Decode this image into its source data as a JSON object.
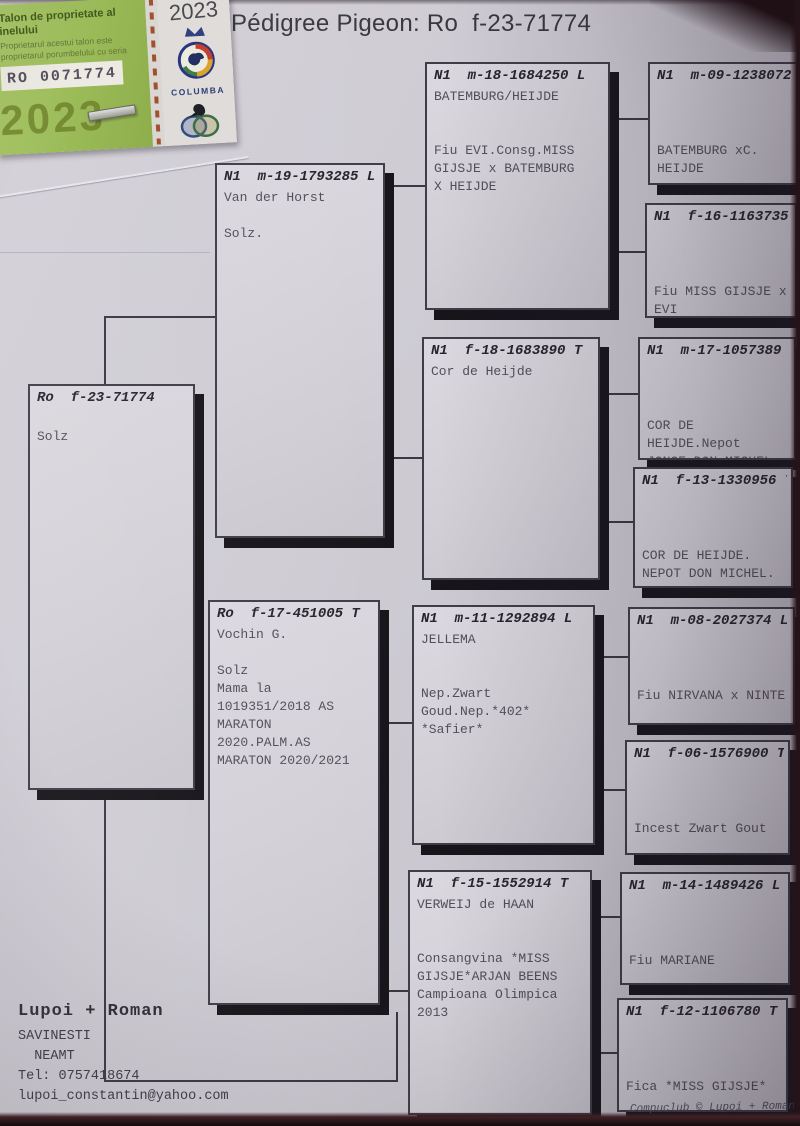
{
  "page": {
    "title": "Pédigree Pigeon: Ro  f-23-71774"
  },
  "sticker": {
    "title": "Talon de proprietate al inelului",
    "subtitle_line1": "Proprietarul acestui talon este",
    "subtitle_line2": "proprietarul porumbelului cu seria",
    "ring_number": "RO 0071774",
    "watermark_year": "2023",
    "right_year": "2023",
    "org_name": "COLUMBA"
  },
  "tree": {
    "boxes": [
      {
        "id": "subject",
        "ring": "Ro  f-23-71774",
        "body": "\nSolz"
      },
      {
        "id": "sire",
        "ring": "N1  m-19-1793285 L",
        "body": "Van der Horst\n\nSolz."
      },
      {
        "id": "dam",
        "ring": "Ro  f-17-451005 T",
        "body": "Vochin G.\n\nSolz\nMama la\n1019351/2018 AS\nMARATON\n2020.PALM.AS\nMARATON 2020/2021"
      },
      {
        "id": "sire-sire",
        "ring": "N1  m-18-1684250 L",
        "body": "BATEMBURG/HEIJDE\n\n\nFiu EVI.Consg.MISS\nGIJSJE x BATEMBURG\nX HEIJDE"
      },
      {
        "id": "sire-dam",
        "ring": "N1  f-18-1683890 T",
        "body": "Cor de Heijde"
      },
      {
        "id": "dam-sire",
        "ring": "N1  m-11-1292894 L",
        "body": "JELLEMA\n\n\nNep.Zwart\nGoud.Nep.*402*\n*Safier*"
      },
      {
        "id": "dam-dam",
        "ring": "N1  f-15-1552914 T",
        "body": "VERWEIJ de HAAN\n\n\nConsangvina *MISS\nGIJSJE*ARJAN BEENS\nCampioana Olimpica\n2013"
      },
      {
        "id": "sire-sire-sire",
        "ring": "N1  m-09-1238072 L",
        "body": "\n\n\nBATEMBURG xC.\nHEIJDE"
      },
      {
        "id": "sire-sire-dam",
        "ring": "N1  f-16-1163735 T",
        "body": "\n\n\nFiu MISS GIJSJE x\nEVI"
      },
      {
        "id": "sire-dam-sire",
        "ring": "N1  m-17-1057389 L",
        "body": "\n\n\nCOR DE HEIJDE.Nepot\nJONGE DON MICHEL"
      },
      {
        "id": "sire-dam-dam",
        "ring": "N1  f-13-1330956 T",
        "body": "\n\n\nCOR DE HEIJDE.\nNEPOT DON MICHEL."
      },
      {
        "id": "dam-sire-sire",
        "ring": "N1  m-08-2027374 L",
        "body": "\n\n\nFiu NIRVANA x NINTE"
      },
      {
        "id": "dam-sire-dam",
        "ring": "N1  f-06-1576900 T",
        "body": "\n\n\nIncest Zwart Gout"
      },
      {
        "id": "dam-dam-sire",
        "ring": "N1  m-14-1489426 L",
        "body": "\n\n\nFiu MARIANE"
      },
      {
        "id": "dam-dam-dam",
        "ring": "N1  f-12-1106780 T",
        "body": "\n\n\nFica *MISS GIJSJE*"
      }
    ]
  },
  "contact": {
    "name": "Lupoi + Roman",
    "city": "SAVINESTI",
    "county": "  NEAMT",
    "phone": "Tel: 0757418674",
    "email": "lupoi_constantin@yahoo.com"
  },
  "footer": {
    "credit": "Compuclub © Lupoi + Roman"
  }
}
